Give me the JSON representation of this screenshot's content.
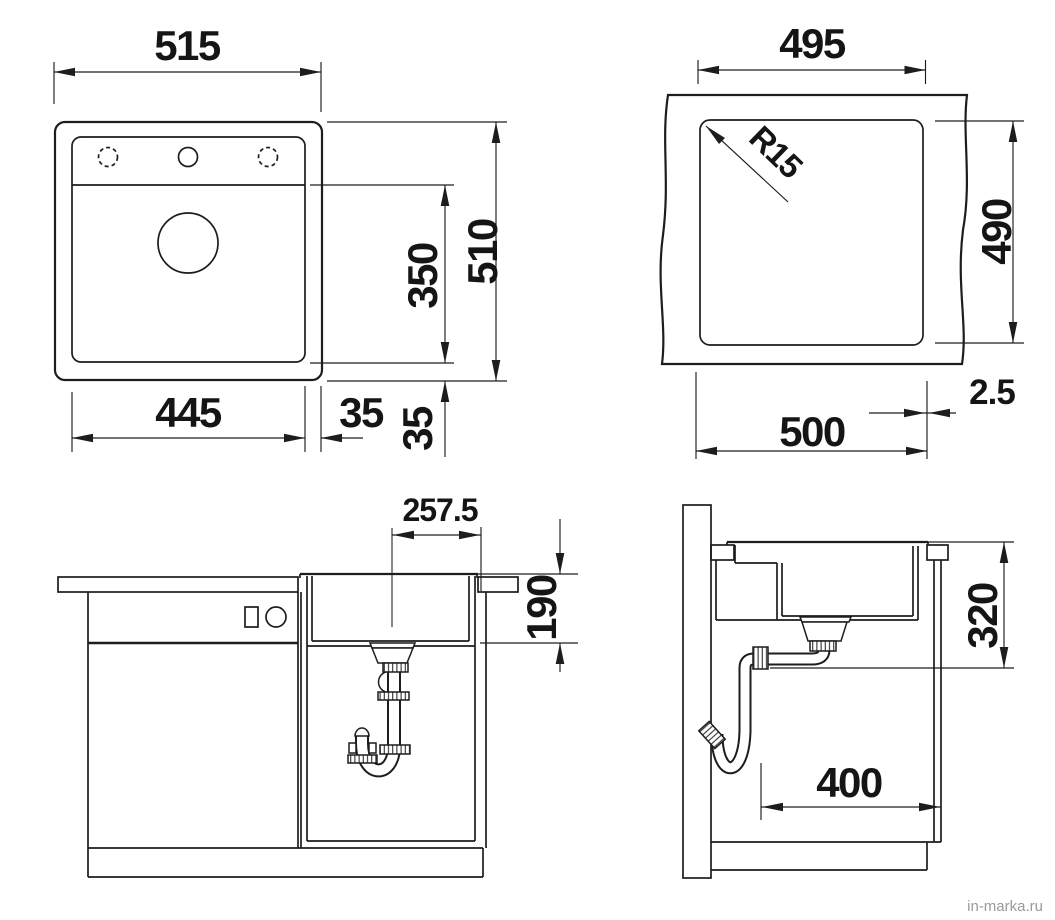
{
  "page": {
    "background": "#ffffff",
    "watermark": {
      "text": "in-marka.ru",
      "color": "#9a9a9a"
    }
  },
  "drawing": {
    "type": "sink installation drawing, four orthographic views",
    "line_color": "#1d1d1d",
    "views": {
      "top": {
        "label": "sink-top-view",
        "dims": {
          "overall_width": "515",
          "overall_depth": "510",
          "bowl_depth": "350",
          "bowl_width": "445",
          "right_margin": "35",
          "front_margin": "35"
        }
      },
      "cutout": {
        "label": "countertop-cutout-view",
        "dims": {
          "bowl_top_width": "495",
          "bowl_top_depth": "490",
          "corner_radius": "R15",
          "cutout_width": "500",
          "edge_offset": "2.5"
        }
      },
      "front": {
        "label": "front-section-view",
        "dims": {
          "drain_center_offset": "257.5",
          "bowl_inner_depth": "190"
        }
      },
      "side": {
        "label": "side-section-view",
        "dims": {
          "drain_outlet_height": "320",
          "drain_wall_distance": "400"
        }
      }
    }
  }
}
